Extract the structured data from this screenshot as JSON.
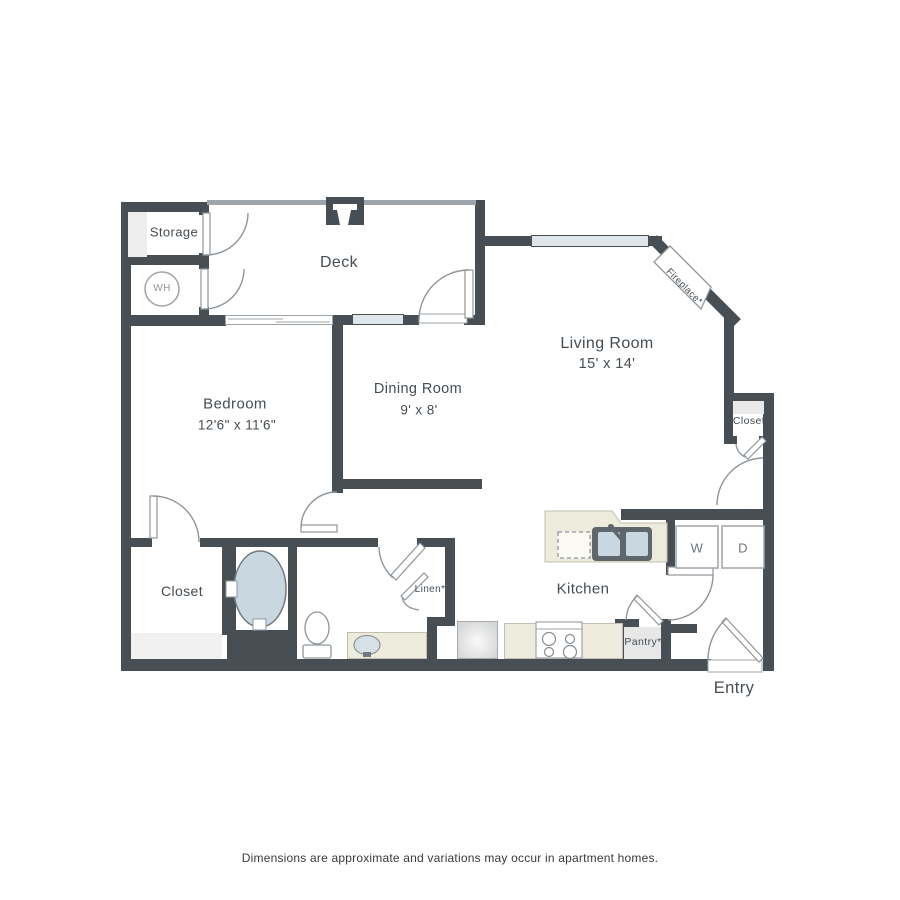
{
  "floorplan": {
    "rooms": {
      "storage": {
        "label": "Storage"
      },
      "water_heater": {
        "label": "WH"
      },
      "deck": {
        "label": "Deck"
      },
      "living_room": {
        "label": "Living Room",
        "dims": "15' x 14'"
      },
      "dining_room": {
        "label": "Dining Room",
        "dims": "9' x 8'"
      },
      "bedroom": {
        "label": "Bedroom",
        "dims": "12'6\" x 11'6\""
      },
      "bedroom_closet": {
        "label": "Closet"
      },
      "hall_closet": {
        "label": "Closet"
      },
      "linen": {
        "label": "Linen*"
      },
      "kitchen": {
        "label": "Kitchen"
      },
      "pantry": {
        "label": "Pantry*"
      },
      "entry": {
        "label": "Entry"
      },
      "fireplace": {
        "label": "Fireplace*"
      },
      "washer": {
        "label": "W"
      },
      "dryer": {
        "label": "D"
      }
    },
    "footer": {
      "disclaimer": "Dimensions are approximate and variations may occur in apartment homes."
    },
    "colors": {
      "wall": "#474F54",
      "railing": "#9FA4A8",
      "window_fill": "#DFE6EA",
      "counter_cream": "#EDEBDC",
      "fixture_blue": "#C9D8E0",
      "light_gray_fill": "#EDEDED",
      "label_text": "#454D53"
    }
  }
}
